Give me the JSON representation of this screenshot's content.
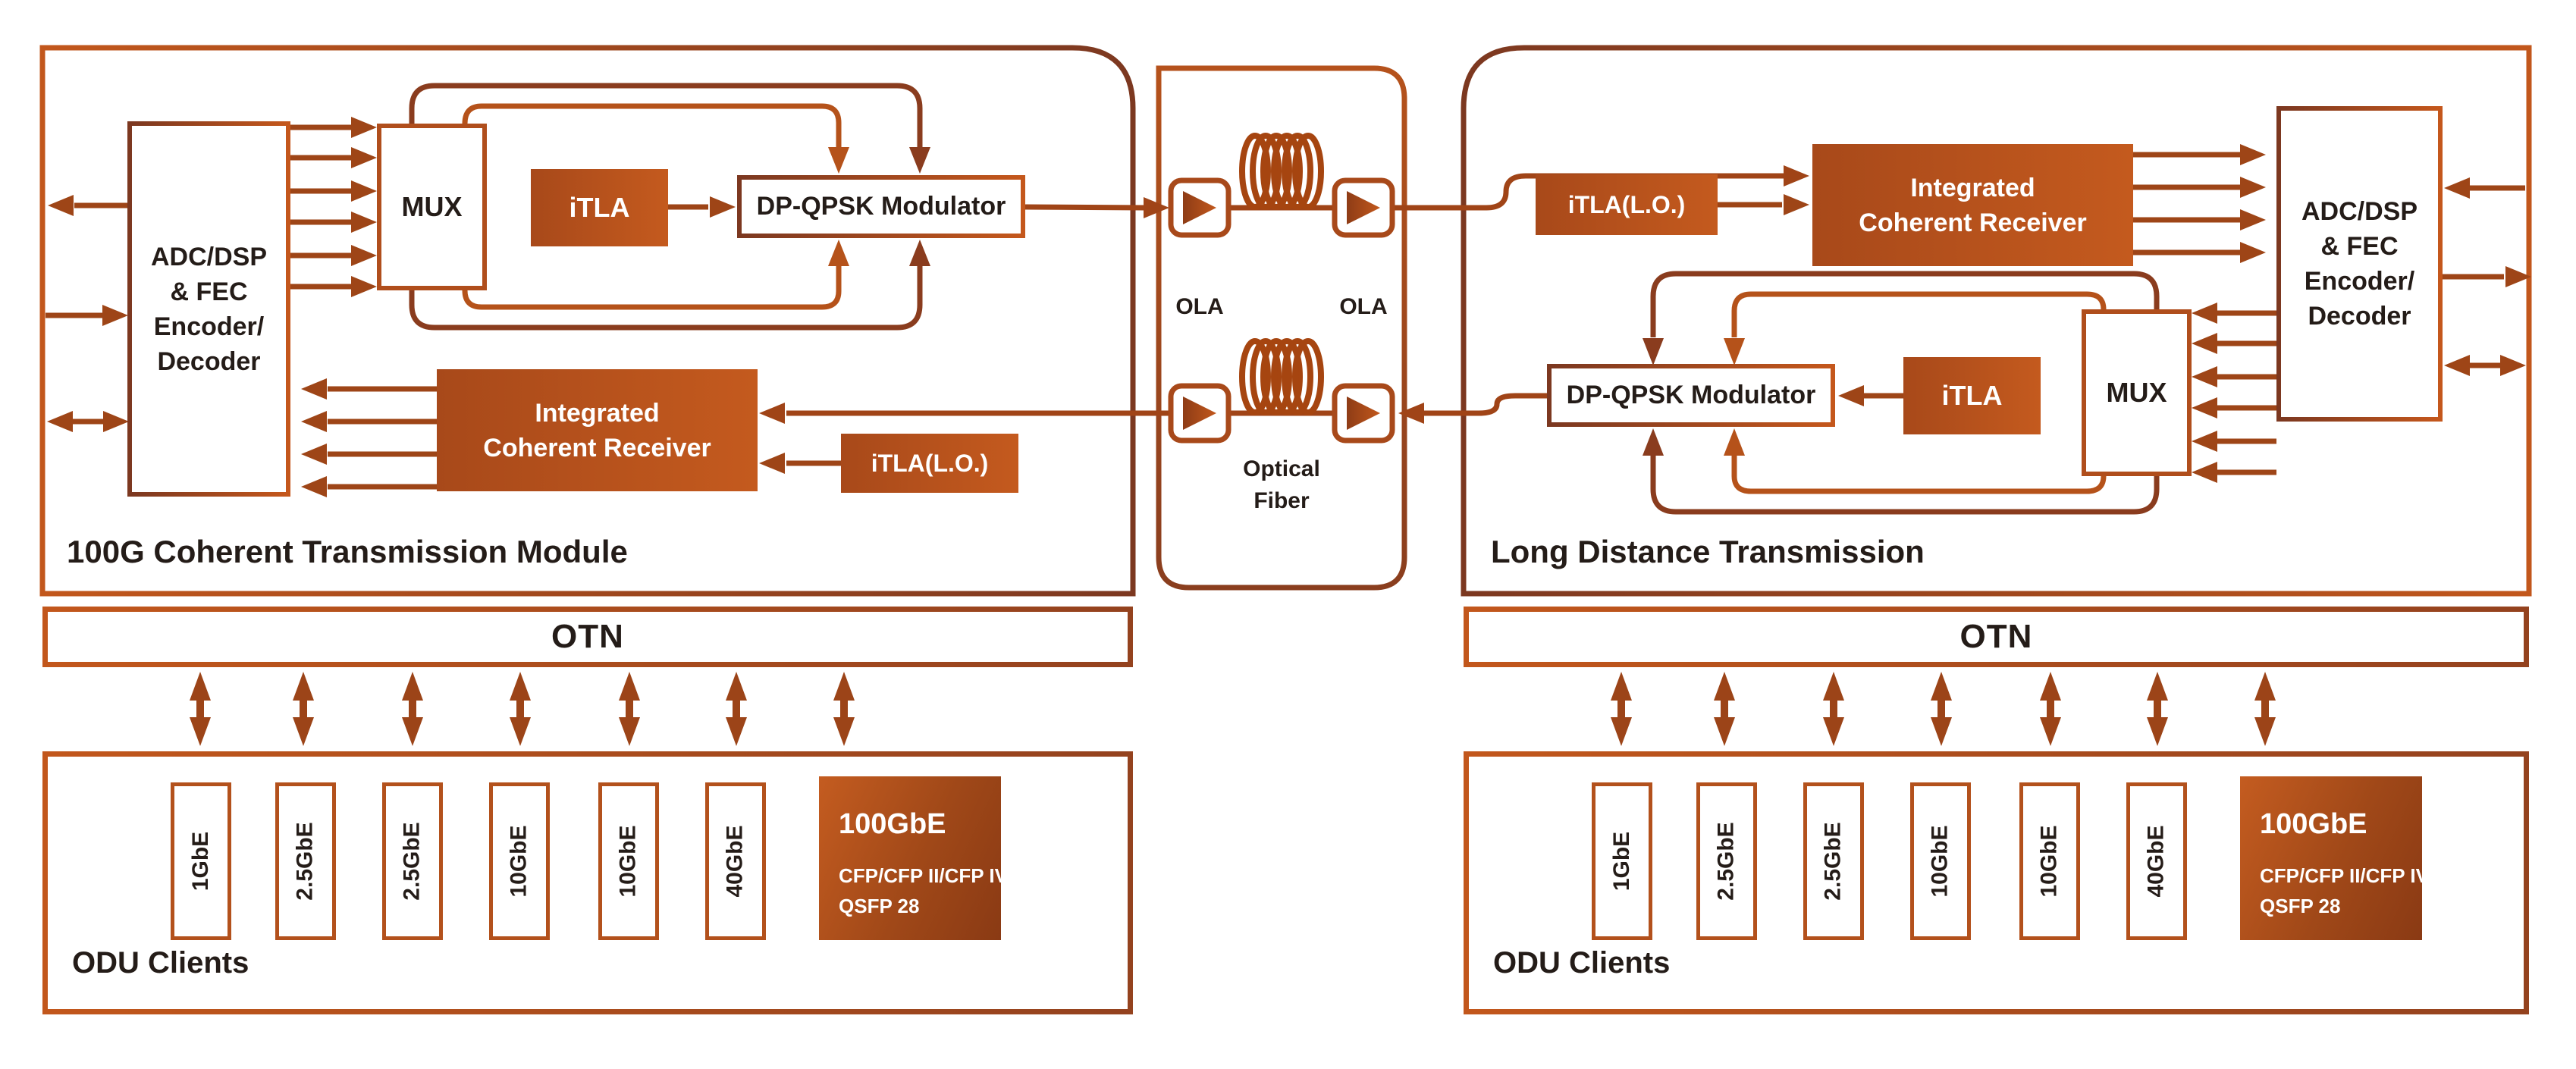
{
  "colors": {
    "accent_orange": "#c4571c",
    "accent_dark": "#7c3820",
    "arrow_brown": "#9e4517",
    "coil_copper": "#a64510",
    "text_dark": "#241c18",
    "text_white": "#ffffff"
  },
  "left_module": {
    "title": "100G Coherent Transmission Module",
    "adc_lines": [
      "ADC/DSP",
      "& FEC",
      "Encoder/",
      "Decoder"
    ],
    "mux_label": "MUX",
    "itla_label": "iTLA",
    "modulator_label": "DP-QPSK Modulator",
    "receiver_lines": [
      "Integrated",
      "Coherent Receiver"
    ],
    "itla_lo_label": "iTLA(L.O.)",
    "otn_label": "OTN",
    "odu_title": "ODU Clients",
    "clients": [
      "1GbE",
      "2.5GbE",
      "2.5GbE",
      "10GbE",
      "10GbE",
      "40GbE"
    ],
    "client_100g": {
      "title": "100GbE",
      "line1": "CFP/CFP II/CFP IV",
      "line2": "QSFP 28"
    }
  },
  "right_module": {
    "title": "Long Distance Transmission",
    "adc_lines": [
      "ADC/DSP",
      "& FEC",
      "Encoder/",
      "Decoder"
    ],
    "mux_label": "MUX",
    "itla_label": "iTLA",
    "modulator_label": "DP-QPSK Modulator",
    "receiver_lines": [
      "Integrated",
      "Coherent Receiver"
    ],
    "itla_lo_label": "iTLA(L.O.)",
    "otn_label": "OTN",
    "odu_title": "ODU Clients",
    "clients": [
      "1GbE",
      "2.5GbE",
      "2.5GbE",
      "10GbE",
      "10GbE",
      "40GbE"
    ],
    "client_100g": {
      "title": "100GbE",
      "line1": "CFP/CFP II/CFP IV",
      "line2": "QSFP 28"
    }
  },
  "fiber_link": {
    "ola_left": "OLA",
    "ola_right": "OLA",
    "label_lines": [
      "Optical",
      "Fiber"
    ]
  }
}
